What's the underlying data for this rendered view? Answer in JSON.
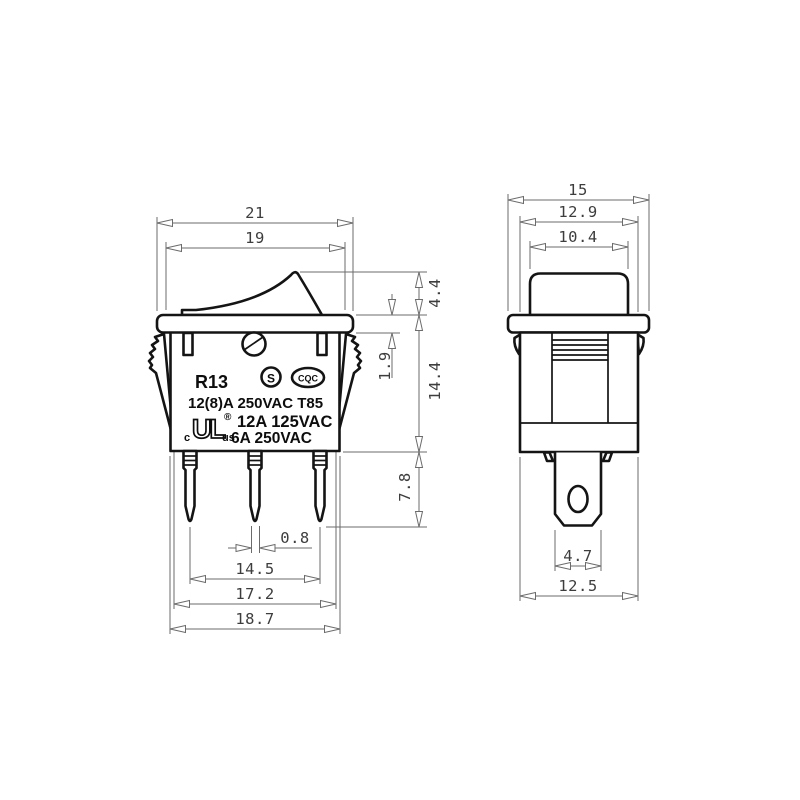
{
  "drawing_title": "rocker switch technical drawing",
  "front_view": {
    "dims": {
      "bezel_width": "21",
      "rocker_width": "19",
      "rocker_height": "4.4",
      "bezel_thickness": "1.9",
      "body_height": "14.4",
      "pin_length": "7.8",
      "pin_width": "0.8",
      "pin_pitch": "14.5",
      "latch_span": "17.2",
      "body_width": "18.7"
    },
    "markings": {
      "model": "R13",
      "rating_line1": "12(8)A 250VAC T85",
      "rating_line2": "12A 125VAC",
      "rating_line3": "6A 250VAC",
      "cert_s": "S",
      "cert_cqc": "CQC",
      "cert_ul": "UL",
      "cert_ul_c": "c",
      "cert_ul_us": "us",
      "cert_ul_reg": "®"
    }
  },
  "side_view": {
    "dims": {
      "bezel_depth": "15",
      "body_depth": "12.9",
      "rocker_depth": "10.4",
      "terminal_width": "4.7",
      "body_bottom_depth": "12.5"
    }
  },
  "colors": {
    "outline": "#141414",
    "dimension_lines": "#6b6b6b",
    "dimension_text": "#3d3d3d",
    "background": "#ffffff"
  }
}
